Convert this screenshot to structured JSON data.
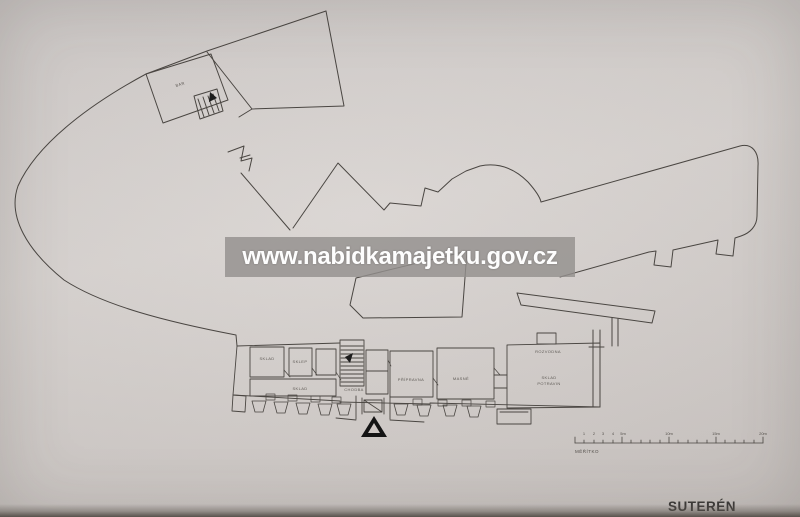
{
  "watermark": {
    "text": "www.nabidkamajetku.gov.cz",
    "band_color": "rgba(148,144,142,0.82)",
    "text_color": "#fdfdfd"
  },
  "title": {
    "text": "SUTERÉN",
    "color": "#3c3a38"
  },
  "plan": {
    "building_label": "BAR",
    "line_color": "#4a4642",
    "label_color": "#5e5a55",
    "marker_icon": "north-arrow-triangle",
    "rooms": [
      {
        "label": "SKLAD"
      },
      {
        "label": "SKLEP"
      },
      {
        "label": "SKLAD"
      },
      {
        "label": "CHODBA"
      },
      {
        "label": "PŘÍPRAVNA"
      },
      {
        "label": "MASNÉ"
      },
      {
        "label": "ROZVODNA"
      },
      {
        "label": "SKLAD"
      },
      {
        "label": "POTRAVIN"
      }
    ]
  },
  "scale_bar": {
    "caption": "MĚŘÍTKO",
    "tick_labels": [
      "1",
      "2",
      "3",
      "4",
      "5m",
      "10m",
      "15m",
      "20m"
    ]
  }
}
